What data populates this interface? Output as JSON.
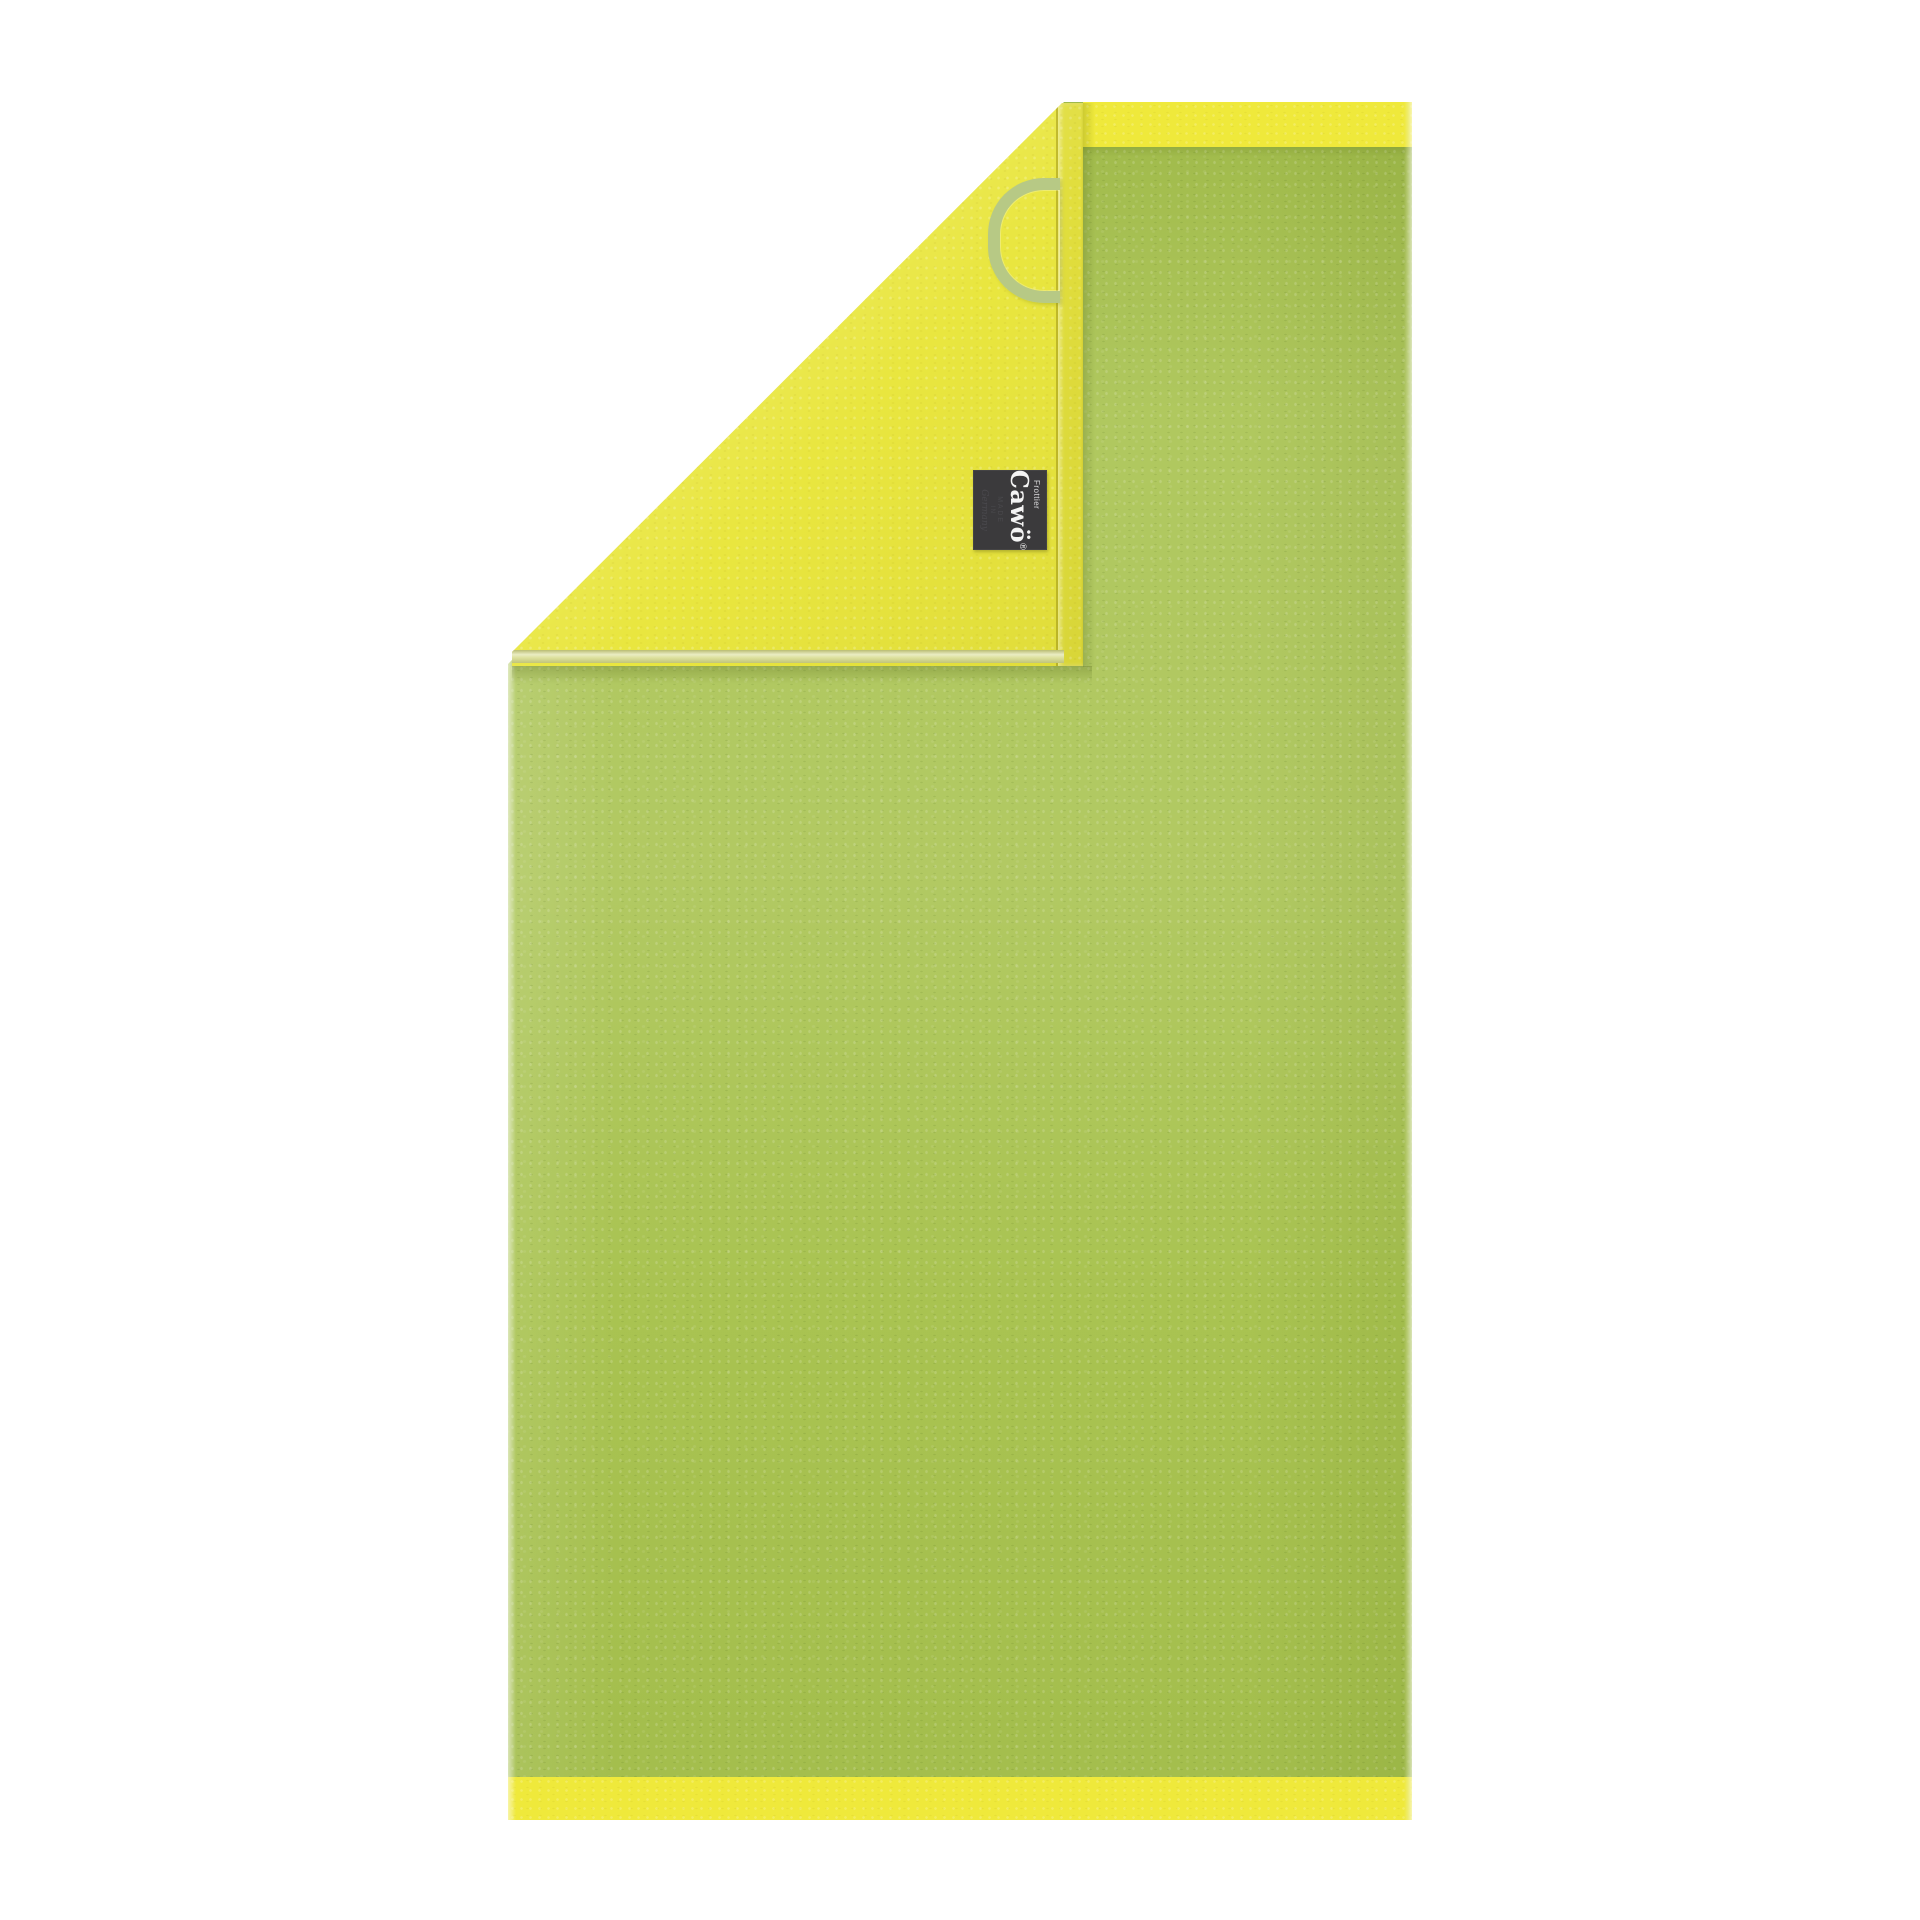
{
  "image": {
    "subject": "Cawö two-tone terry towel, lime green front with yellow reverse side, top-left corner folded over showing brand label and hanging loop",
    "background_color": "#ffffff"
  },
  "towel": {
    "front_color": "#a9c351",
    "front_highlight_color": "#b8cf63",
    "reverse_color": "#e9e63f",
    "border_band_color": "#efe93b",
    "hem_ribbon_color": "#d9dd92",
    "hanging_loop_color": "#b7c985",
    "edge_highlight_color": "#eef2d2"
  },
  "label": {
    "background_color": "#3b3a3c",
    "brand_prefix": "Frottier",
    "brand_name": "Cawö",
    "registered_mark": "®",
    "origin_line1": "MADE",
    "origin_line2": "IN",
    "origin_line3": "Germany",
    "brand_text_color": "#f4f4f4",
    "origin_text_color": "#4a494d"
  }
}
